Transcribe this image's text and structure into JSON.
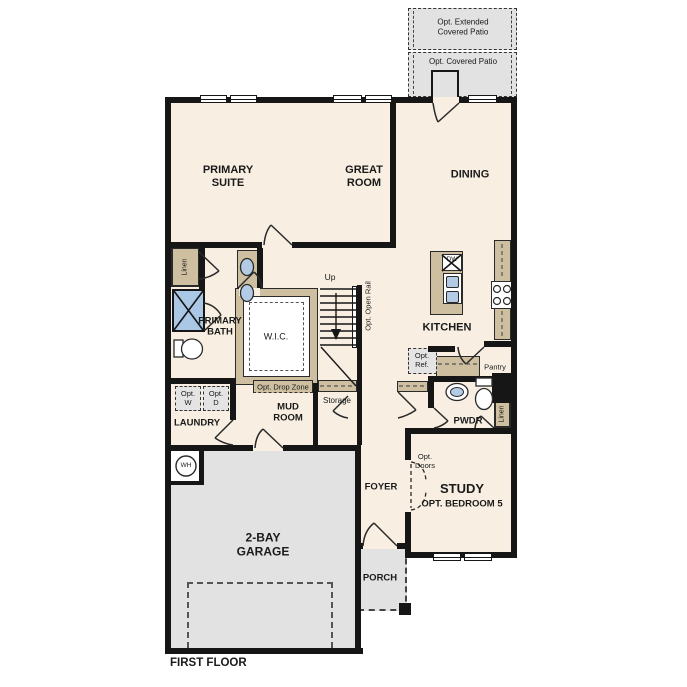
{
  "plan": {
    "title": "FIRST FLOOR",
    "type": "single-family home first floor plan"
  },
  "colors": {
    "wall": "#161616",
    "floor": "#f8efe2",
    "garage_floor": "#e2e2e2",
    "patio": "#e4e4e4",
    "cabinet": "#cdbf9f",
    "fixture_blue": "#b3cbe5",
    "background": "#ffffff"
  },
  "labels": {
    "opt_extended_patio": "Opt. Extended\nCovered Patio",
    "opt_covered_patio": "Opt. Covered Patio",
    "primary_suite": "PRIMARY\nSUITE",
    "great_room": "GREAT\nROOM",
    "dining": "DINING",
    "kitchen": "KITCHEN",
    "dishwasher": "DW",
    "primary_bath": "PRIMARY\nBATH",
    "wic": "W.I.C.",
    "linen_left": "Linen",
    "linen_right": "Linen",
    "up": "Up",
    "opt_open_rail": "Opt. Open Rail",
    "opt_drop_zone": "Opt. Drop Zone",
    "mud_room": "MUD\nROOM",
    "storage": "Storage",
    "laundry": "LAUNDRY",
    "opt_washer": "Opt.\nW",
    "opt_dryer": "Opt.\nD",
    "water_heater": "WH",
    "opt_ref": "Opt.\nRef.",
    "pantry": "Pantry",
    "pwdr": "PWDR",
    "foyer": "FOYER",
    "study": "STUDY",
    "opt_bedroom_5": "OPT. BEDROOM 5",
    "opt_doors": "Opt.\nDoors",
    "garage": "2-BAY\nGARAGE",
    "porch": "PORCH",
    "first_floor": "FIRST FLOOR"
  }
}
